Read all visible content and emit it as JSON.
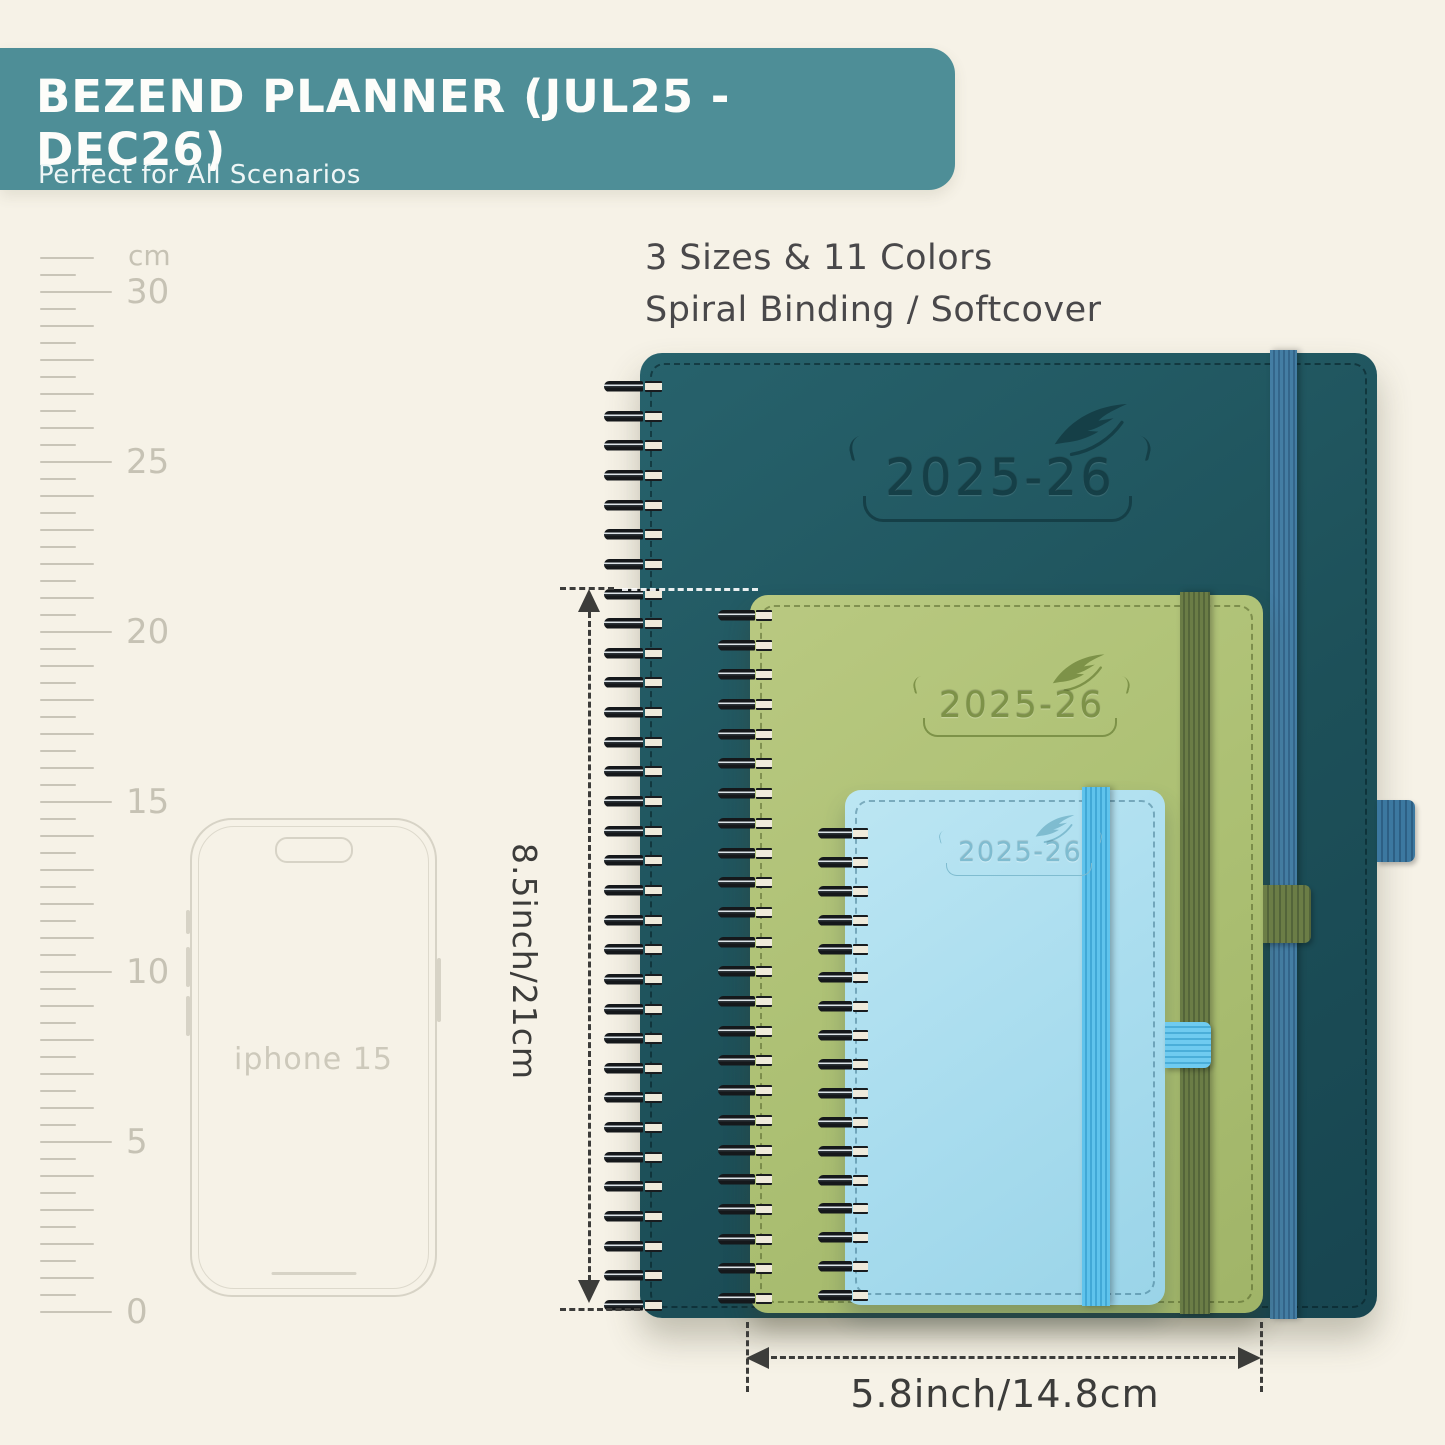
{
  "banner": {
    "title": "BEZEND PLANNER (JUL25 - DEC26)",
    "subtitle": "Perfect for All Scenarios",
    "bg_color": "#4e8e97"
  },
  "headline": {
    "line1": "3 Sizes & 11 Colors",
    "line2": "Spiral Binding / Softcover"
  },
  "ruler": {
    "unit": "cm",
    "labels": [
      "30",
      "25",
      "20",
      "15",
      "10",
      "5",
      "0"
    ]
  },
  "phone": {
    "label": "iphone 15"
  },
  "planners": {
    "large": {
      "year": "2025-26",
      "cover_color": "#1d5059",
      "band_color": "#3c78a0"
    },
    "medium": {
      "year": "2025-26",
      "cover_color": "#abbf72",
      "band_color": "#5f7340"
    },
    "small": {
      "year": "2025-26",
      "cover_color": "#a8dcee",
      "band_color": "#54c0ea"
    }
  },
  "dimensions": {
    "height_label": "8.5inch/21cm",
    "width_label": "5.8inch/14.8cm"
  }
}
